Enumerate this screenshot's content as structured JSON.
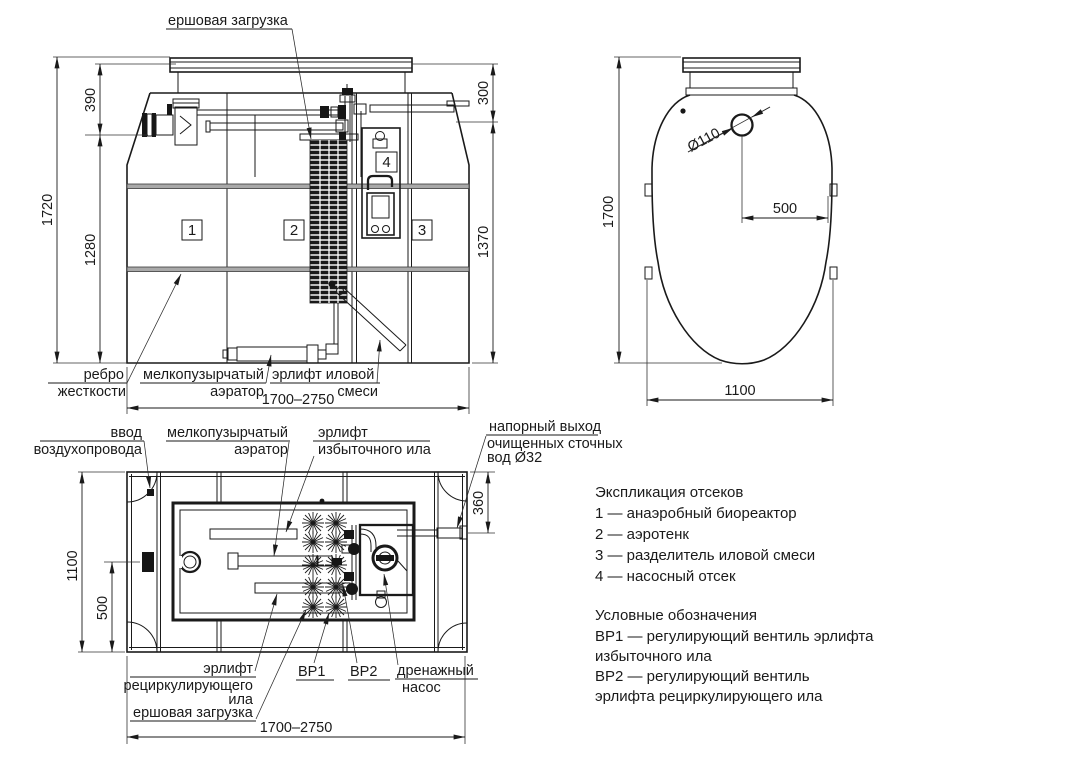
{
  "colors": {
    "ink": "#1a1a1a",
    "paper": "#ffffff"
  },
  "front": {
    "label_ersh": "ершовая загрузка",
    "label_rebro1": "ребро",
    "label_rebro2": "жесткости",
    "label_aer1": "мелкопузырчатый",
    "label_aer2": "аэратор",
    "label_airlift1": "эрлифт иловой",
    "label_airlift2": "смеси",
    "dim_1720": "1720",
    "dim_390": "390",
    "dim_1280": "1280",
    "dim_300": "300",
    "dim_1370": "1370",
    "dim_width": "1700–2750",
    "comp1": "1",
    "comp2": "2",
    "comp3": "3",
    "comp4": "4"
  },
  "side": {
    "dim_1700": "1700",
    "dim_d110": "Ø110",
    "dim_500": "500",
    "dim_1100": "1100"
  },
  "plan": {
    "label_air1": "ввод",
    "label_air2": "воздухопровода",
    "label_aer1": "мелкопузырчатый",
    "label_aer2": "аэратор",
    "label_excess1": "эрлифт",
    "label_excess2": "избыточного ила",
    "label_out1": "напорный выход",
    "label_out2": "очищенных сточных",
    "label_out3": "вод Ø32",
    "label_recirc1": "эрлифт",
    "label_recirc2": "рециркулирующего",
    "label_recirc3": "ила",
    "label_ersh": "ершовая загрузка",
    "label_bp1": "ВР1",
    "label_bp2": "ВР2",
    "label_pump1": "дренажный",
    "label_pump2": "насос",
    "dim_1100": "1100",
    "dim_500": "500",
    "dim_360": "360",
    "dim_width": "1700–2750"
  },
  "legend": {
    "lines": [
      "Экспликация отсеков",
      "1 —  анаэробный биореактор",
      "2 —  аэротенк",
      "3 —  разделитель иловой смеси",
      "4 —  насосный отсек",
      "Условные обозначения",
      "ВР1 —  регулирующий вентиль эрлифта",
      "избыточного ила",
      "ВР2 —  регулирующий вентиль",
      "эрлифта рециркулирующего ила"
    ]
  }
}
